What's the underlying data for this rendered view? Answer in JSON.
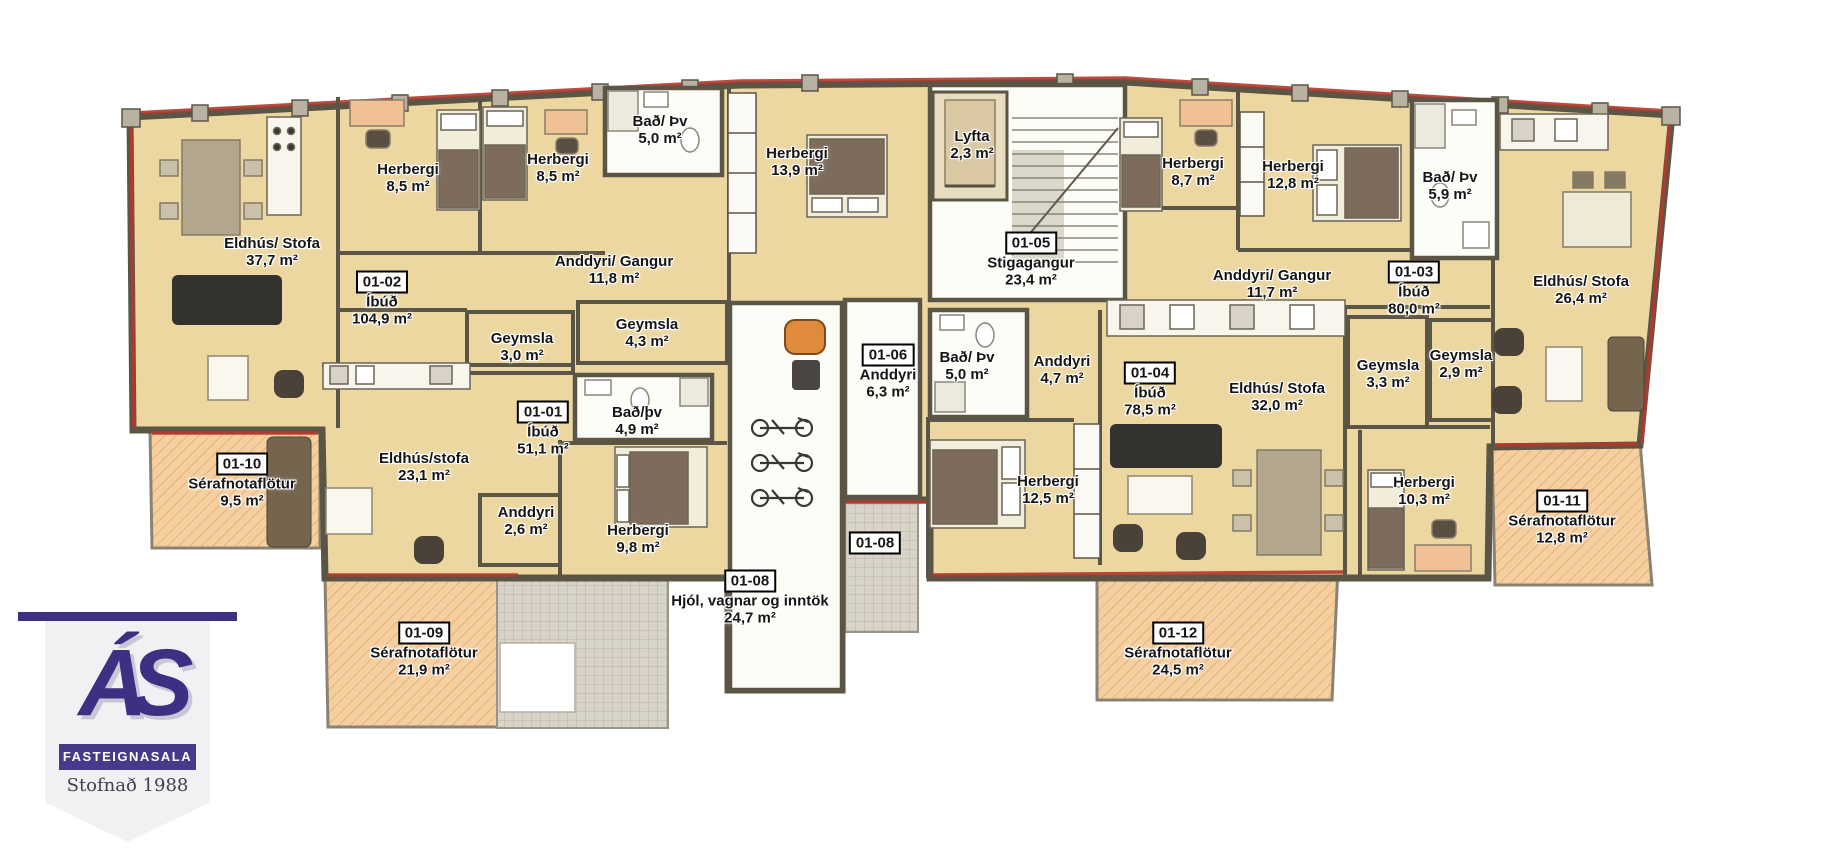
{
  "palette": {
    "floor": "#ecd7a1",
    "patio": "#f6cfa0",
    "patio_hatch": "#e5b47c",
    "wall": "#5b5546",
    "wall_light": "#b9b2a3",
    "red_accent": "#b2392d",
    "white_room": "#fdfdf8",
    "pavement": "#d9d4c8",
    "logo_purple": "#3e2f82",
    "sofa_dark": "#34322c",
    "sofa_brown": "#75654f",
    "bed_blanket": "#7d6c5b",
    "desk_orange": "#f0c195"
  },
  "logo": {
    "monogram": "ÁS",
    "company": "FASTEIGNASALA",
    "tagline": "Stofnað 1988"
  },
  "room_labels": [
    {
      "name": "Eldhús/ Stofa",
      "area": "37,7 m²"
    },
    {
      "name": "Herbergi",
      "area": "8,5 m²"
    },
    {
      "name": "Herbergi",
      "area": "8,5 m²"
    },
    {
      "name": "Bað/ Þv",
      "area": "5,0 m²"
    },
    {
      "name": "Herbergi",
      "area": "13,9 m²"
    },
    {
      "name": "Anddyri/ Gangur",
      "area": "11,8 m²"
    },
    {
      "name": "Geymsla",
      "area": "3,0 m²"
    },
    {
      "name": "Geymsla",
      "area": "4,3 m²"
    },
    {
      "name": "Lyfta",
      "area": "2,3 m²"
    },
    {
      "name": "Bað/ Þv",
      "area": "5,0 m²"
    },
    {
      "name": "Anddyri",
      "area": "4,7 m²"
    },
    {
      "name": "Eldhús/ Stofa",
      "area": "32,0 m²"
    },
    {
      "name": "Geymsla",
      "area": "3,3 m²"
    },
    {
      "name": "Geymsla",
      "area": "2,9 m²"
    },
    {
      "name": "Herbergi",
      "area": "12,5 m²"
    },
    {
      "name": "Herbergi",
      "area": "8,7 m²"
    },
    {
      "name": "Herbergi",
      "area": "12,8 m²"
    },
    {
      "name": "Bað/ Þv",
      "area": "5,9 m²"
    },
    {
      "name": "Anddyri/ Gangur",
      "area": "11,7 m²"
    },
    {
      "name": "Eldhús/ Stofa",
      "area": "26,4 m²"
    },
    {
      "name": "Herbergi",
      "area": "10,3 m²"
    },
    {
      "name": "Bað/þv",
      "area": "4,9 m²"
    },
    {
      "name": "Eldhús/stofa",
      "area": "23,1 m²"
    },
    {
      "name": "Anddyri",
      "area": "2,6 m²"
    },
    {
      "name": "Herbergi",
      "area": "9,8 m²"
    }
  ],
  "unit_labels": [
    {
      "id": "01-02",
      "type": "Íbúð",
      "area": "104,9 m²"
    },
    {
      "id": "01-01",
      "type": "Íbúð",
      "area": "51,1 m²"
    },
    {
      "id": "01-03",
      "type": "Íbúð",
      "area": "80,0 m²"
    },
    {
      "id": "01-04",
      "type": "Íbúð",
      "area": "78,5 m²"
    },
    {
      "id": "01-05",
      "type": "Stigagangur",
      "area": "23,4 m²"
    },
    {
      "id": "01-06",
      "type": "Anddyri",
      "area": "6,3 m²"
    },
    {
      "id": "01-08",
      "type": "Hjól, vagnar og inntök",
      "area": "24,7 m²"
    },
    {
      "id": "01-08",
      "type": "",
      "area": ""
    },
    {
      "id": "01-09",
      "type": "Sérafnotaflötur",
      "area": "21,9 m²"
    },
    {
      "id": "01-10",
      "type": "Sérafnotaflötur",
      "area": "9,5 m²"
    },
    {
      "id": "01-11",
      "type": "Sérafnotaflötur",
      "area": "12,8 m²"
    },
    {
      "id": "01-12",
      "type": "Sérafnotaflötur",
      "area": "24,5 m²"
    }
  ]
}
